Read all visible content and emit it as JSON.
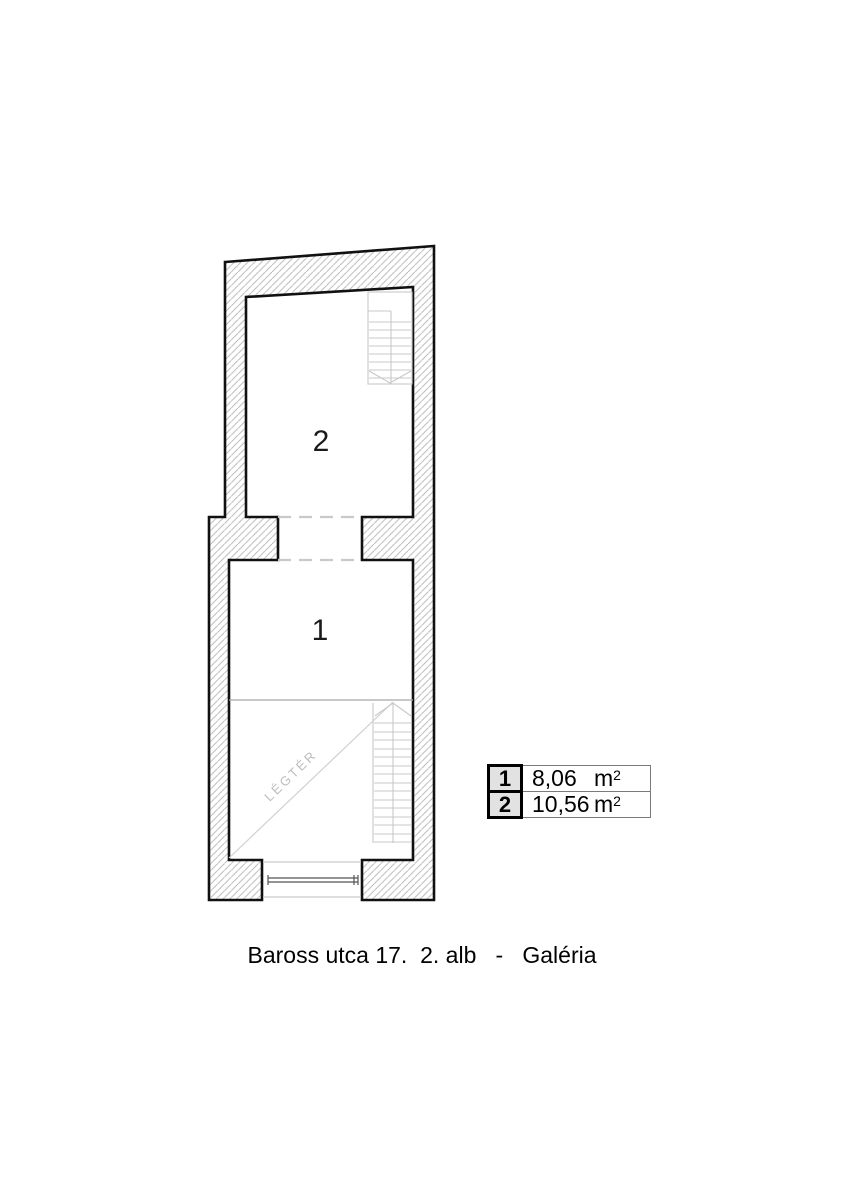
{
  "plan": {
    "room1_label": "1",
    "room2_label": "2",
    "airspace_label": "LÉGTÉR"
  },
  "legend": {
    "rows": [
      {
        "id": "1",
        "area": "8,06",
        "unit_base": "m",
        "unit_exp": "2"
      },
      {
        "id": "2",
        "area": "10,56",
        "unit_base": "m",
        "unit_exp": "2"
      }
    ]
  },
  "caption": {
    "text": "Baross utca 17.  2. alb   -   Galéria"
  },
  "colors": {
    "wall_outline": "#111111",
    "hatch_line": "#b3b3b3",
    "stair_line": "#c8c8c8",
    "dashed_opening": "#c9c9c9",
    "gallery_edge": "#a8a8a8",
    "diagonal_line": "#d0d0d0",
    "railing": "#555555",
    "legend_cell_bg": "#e2e2e2",
    "text": "#000000"
  }
}
